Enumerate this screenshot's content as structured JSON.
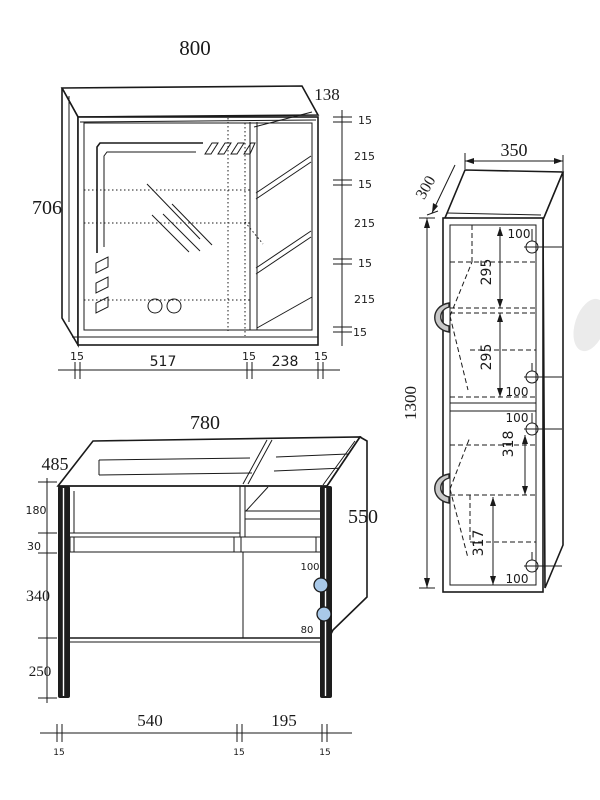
{
  "title": "bathroom-cabinet-technical-drawing",
  "mirror_cabinet": {
    "width": "800",
    "height": "706",
    "depth": "138",
    "right_chain": [
      "15",
      "215",
      "15",
      "215",
      "15",
      "215",
      "15"
    ],
    "bottom_chain": [
      "15",
      "517",
      "15",
      "238",
      "15"
    ]
  },
  "vanity": {
    "width": "780",
    "depth": "485",
    "side_height": "550",
    "left_chain": [
      "180",
      "30",
      "340",
      "250"
    ],
    "bottom_widths": [
      "540",
      "195"
    ],
    "bottom_thickness": [
      "15",
      "15",
      "15"
    ],
    "hole_top": "100",
    "hole_bottom": "80"
  },
  "tall_cabinet": {
    "width": "350",
    "depth": "300",
    "height": "1300",
    "upper_hole_top": "100",
    "upper_section_1": "295",
    "upper_section_2": "295",
    "upper_hole_bottom": "100",
    "lower_hole_top": "100",
    "lower_section_1": "318",
    "lower_section_2": "317",
    "lower_hole_bottom": "100"
  }
}
